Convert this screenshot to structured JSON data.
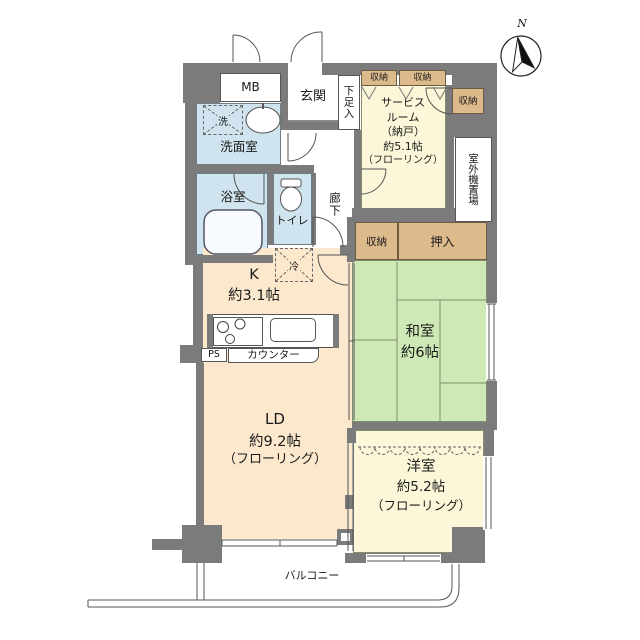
{
  "compass": {
    "north": "N"
  },
  "palette": {
    "wall": "#7b7b7b",
    "water_rooms": "#cfe4ee",
    "ld_kitchen": "#fbe8cd",
    "cream_rooms": "#fbf7d8",
    "tatami": "#cfe9b6",
    "storage": "#dcba8b"
  },
  "labels": {
    "mb": "MB",
    "genkan": "玄関",
    "shoe_box": "下足入",
    "washroom": "洗面室",
    "washer": "洗",
    "bathroom": "浴室",
    "toilet": "トイレ",
    "hallway": "廊下",
    "fridge": "冷",
    "closet_top_left": "収納",
    "closet_top_right": "収納",
    "closet_right": "収納",
    "closet_hall": "収納",
    "oshiire": "押入",
    "outdoor_unit": "室外機置場",
    "ps": "PS",
    "counter": "カウンター",
    "balcony": "バルコニー"
  },
  "rooms": {
    "service": {
      "l1": "サービス",
      "l2": "ルーム",
      "l3": "（納戸）",
      "l4": "約5.1帖",
      "l5": "（フローリング）"
    },
    "kitchen": {
      "name": "K",
      "size": "約3.1帖"
    },
    "ld": {
      "name": "LD",
      "size": "約9.2帖",
      "floor": "（フローリング）"
    },
    "washitsu": {
      "name": "和室",
      "size": "約6帖"
    },
    "youshitsu": {
      "name": "洋室",
      "size": "約5.2帖",
      "floor": "（フローリング）"
    }
  }
}
